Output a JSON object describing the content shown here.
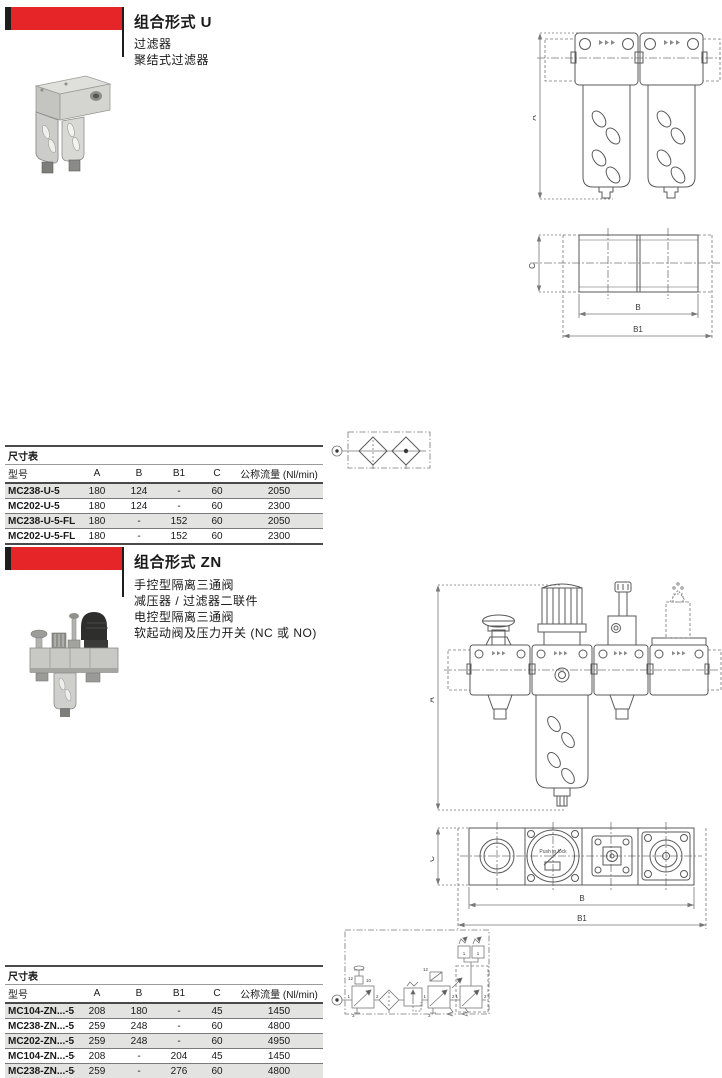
{
  "page": {
    "bg": "#ffffff",
    "accent_red": "#e62529",
    "banner_black": "#1d1d1b",
    "row_alt_gray": "#e3e3e2",
    "rule_dark": "#4a4a4a",
    "drawing_line": "#5a5a5a"
  },
  "section_u": {
    "title": "组合形式 U",
    "desc_lines": [
      "过滤器",
      "聚结式过滤器"
    ],
    "front_view": {
      "dim_label": "A"
    },
    "bottom_view": {
      "dim_c": "C",
      "dim_b": "B",
      "dim_b1": "B1"
    },
    "table": {
      "caption": "尺寸表",
      "columns": [
        "型号",
        "A",
        "B",
        "B1",
        "C",
        "公称流量 (Nl/min)"
      ],
      "rows": [
        [
          "MC238-U-5",
          "180",
          "124",
          "-",
          "60",
          "2050"
        ],
        [
          "MC202-U-5",
          "180",
          "124",
          "-",
          "60",
          "2300"
        ],
        [
          "MC238-U-5-FL",
          "180",
          "-",
          "152",
          "60",
          "2050"
        ],
        [
          "MC202-U-5-FL",
          "180",
          "-",
          "152",
          "60",
          "2300"
        ]
      ]
    }
  },
  "section_zn": {
    "title": "组合形式 ZN",
    "desc_lines": [
      "手控型隔离三通阀",
      "减压器 / 过滤器二联件",
      "电控型隔离三通阀",
      "软起动阀及压力开关 (NC 或 NO)"
    ],
    "front_view": {
      "dim_label": "A"
    },
    "bottom_view": {
      "dim_c": "C",
      "dim_b": "B",
      "dim_b1": "B1",
      "gauge_text": "Push to lock"
    },
    "circuit": {
      "valve1": {
        "pilot": "12",
        "detent": "10",
        "p1": "1",
        "p2": "2",
        "p3": "3"
      },
      "valve2": {
        "pilot": "12",
        "p1": "1",
        "p2": "2",
        "p3": "3"
      },
      "soft_start": {
        "p1": "1",
        "p2": "2"
      },
      "pressure_switches": [
        "1",
        "1"
      ]
    },
    "table": {
      "caption": "尺寸表",
      "columns": [
        "型号",
        "A",
        "B",
        "B1",
        "C",
        "公称流量 (Nl/min)"
      ],
      "rows": [
        [
          "MC104-ZN...-5",
          "208",
          "180",
          "-",
          "45",
          "1450"
        ],
        [
          "MC238-ZN...-5",
          "259",
          "248",
          "-",
          "60",
          "4800"
        ],
        [
          "MC202-ZN...-5",
          "259",
          "248",
          "-",
          "60",
          "4950"
        ],
        [
          "MC104-ZN...-5-FL",
          "208",
          "-",
          "204",
          "45",
          "1450"
        ],
        [
          "MC238-ZN...-5-FL",
          "259",
          "-",
          "276",
          "60",
          "4800"
        ],
        [
          "MC202-ZN...-5-FL",
          "259",
          "-",
          "276",
          "60",
          "4950"
        ]
      ]
    }
  }
}
